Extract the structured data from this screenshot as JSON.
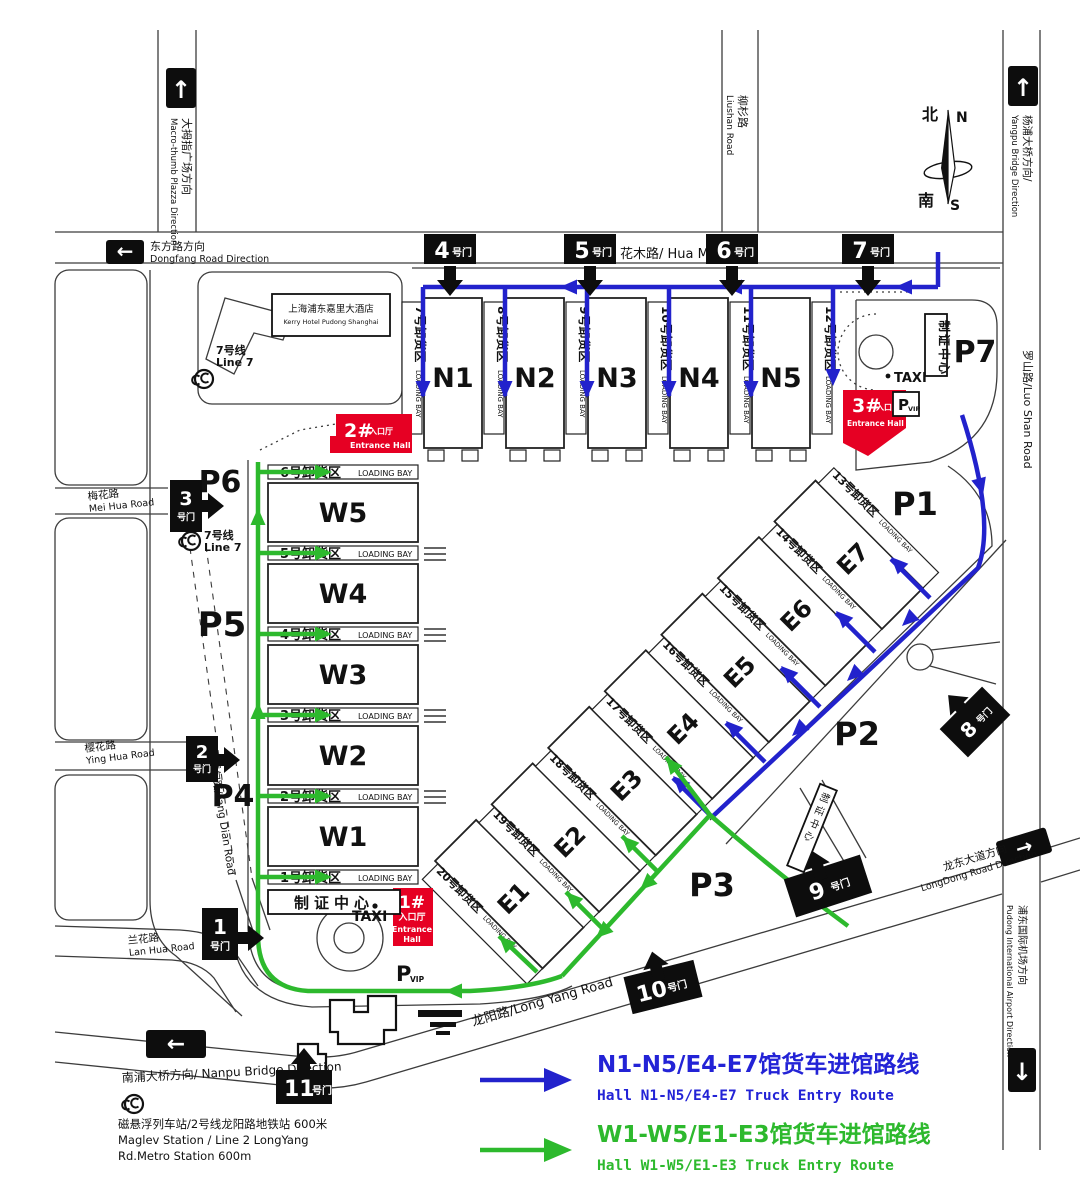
{
  "colors": {
    "route_blue": "#2222cc",
    "route_green": "#2db92d",
    "entrance_red": "#e60023",
    "gate_black": "#0d0d0d"
  },
  "compass": {
    "n_cn": "北",
    "n_en": "N",
    "s_cn": "南",
    "s_en": "S"
  },
  "halls": {
    "north": [
      "N1",
      "N2",
      "N3",
      "N4",
      "N5"
    ],
    "west": [
      "W5",
      "W4",
      "W3",
      "W2",
      "W1"
    ],
    "east": [
      "E1",
      "E2",
      "E3",
      "E4",
      "E5",
      "E6",
      "E7"
    ]
  },
  "parking": [
    "P1",
    "P2",
    "P3",
    "P4",
    "P5",
    "P6",
    "P7"
  ],
  "gates": [
    {
      "n": "1",
      "s": "号门"
    },
    {
      "n": "2",
      "s": "号门"
    },
    {
      "n": "3",
      "s": "号门"
    },
    {
      "n": "4",
      "s": "号门"
    },
    {
      "n": "5",
      "s": "号门"
    },
    {
      "n": "6",
      "s": "号门"
    },
    {
      "n": "7",
      "s": "号门"
    },
    {
      "n": "8",
      "s": "号门"
    },
    {
      "n": "9",
      "s": "号门"
    },
    {
      "n": "10",
      "s": "号门"
    },
    {
      "n": "11",
      "s": "号门"
    }
  ],
  "loading_bays": {
    "loading_bay_en": "LOADING BAY",
    "west": [
      "6号卸货区",
      "5号卸货区",
      "4号卸货区",
      "3号卸货区",
      "2号卸货区",
      "1号卸货区"
    ],
    "north": [
      "7号卸货区",
      "8号卸货区",
      "9号卸货区",
      "10号卸货区",
      "11号卸货区",
      "12号卸货区"
    ],
    "east": [
      "13号卸货区",
      "14号卸货区",
      "15号卸货区",
      "16号卸货区",
      "17号卸货区",
      "18号卸货区",
      "19号卸货区",
      "20号卸货区"
    ]
  },
  "entrances": [
    {
      "num": "1#",
      "cn": "入口厅",
      "en": "Entrance Hall",
      "en1": "Entrance",
      "en2": "Hall"
    },
    {
      "num": "2#",
      "cn": "入口厅",
      "en": "Entrance Hall"
    },
    {
      "num": "3#",
      "cn": "入口厅",
      "en": "Entrance Hall"
    }
  ],
  "roads": {
    "macrothumb_cn": "大拇指广场方向",
    "macrothumb_en": "Macro-thumb Plazza Direction",
    "dongfang_cn": "东方路方向",
    "dongfang_en": "Dongfang Road Direction",
    "huamu": "花木路/ Hua Mu Road",
    "liushan_cn": "柳杉路",
    "liushan_en": "Liushan Road",
    "yangpu_cn": "杨浦大桥方向/",
    "yangpu_en": "Yangpu Bridge Direction",
    "luoshan": "罗山路/Luo Shan Road",
    "longdong_cn": "龙东大道方向",
    "longdong_en": "LongDong Road Direction",
    "pudong_cn": "浦东国际机场方向",
    "pudong_en": "Pudong International Airport Direction",
    "nanpu": "南浦大桥方向/ Nanpu Bridge Direction",
    "meihua_cn": "梅花路",
    "meihua_en": "Mei Hua Road",
    "yinghua_cn": "樱花路",
    "yinghua_en": "Ying Hua Road",
    "lanhua_cn": "兰花路",
    "lanhua_en": "Lan Hua Road",
    "fangdian": "芳甸路/Fang Dian Road",
    "longyang": "龙阳路/Long Yang Road"
  },
  "facilities": {
    "taxi": "TAXI",
    "p": "P",
    "vip": "VIP",
    "cert_center": "制证中心",
    "hotel_cn": "上海浦东嘉里大酒店",
    "hotel_en": "Kerry Hotel Pudong Shanghai",
    "line7_cn": "7号线",
    "line7_en": "Line 7",
    "maglev_cn": "磁悬浮列车站/2号线龙阳路地铁站 600米",
    "maglev_en1": "Maglev Station / Line 2 LongYang",
    "maglev_en2": "Rd.Metro Station 600m"
  },
  "legend": {
    "blue_cn": "N1-N5/E4-E7馆货车进馆路线",
    "blue_en": "Hall N1-N5/E4-E7 Truck Entry Route",
    "green_cn": "W1-W5/E1-E3馆货车进馆路线",
    "green_en": "Hall W1-W5/E1-E3 Truck Entry Route"
  }
}
